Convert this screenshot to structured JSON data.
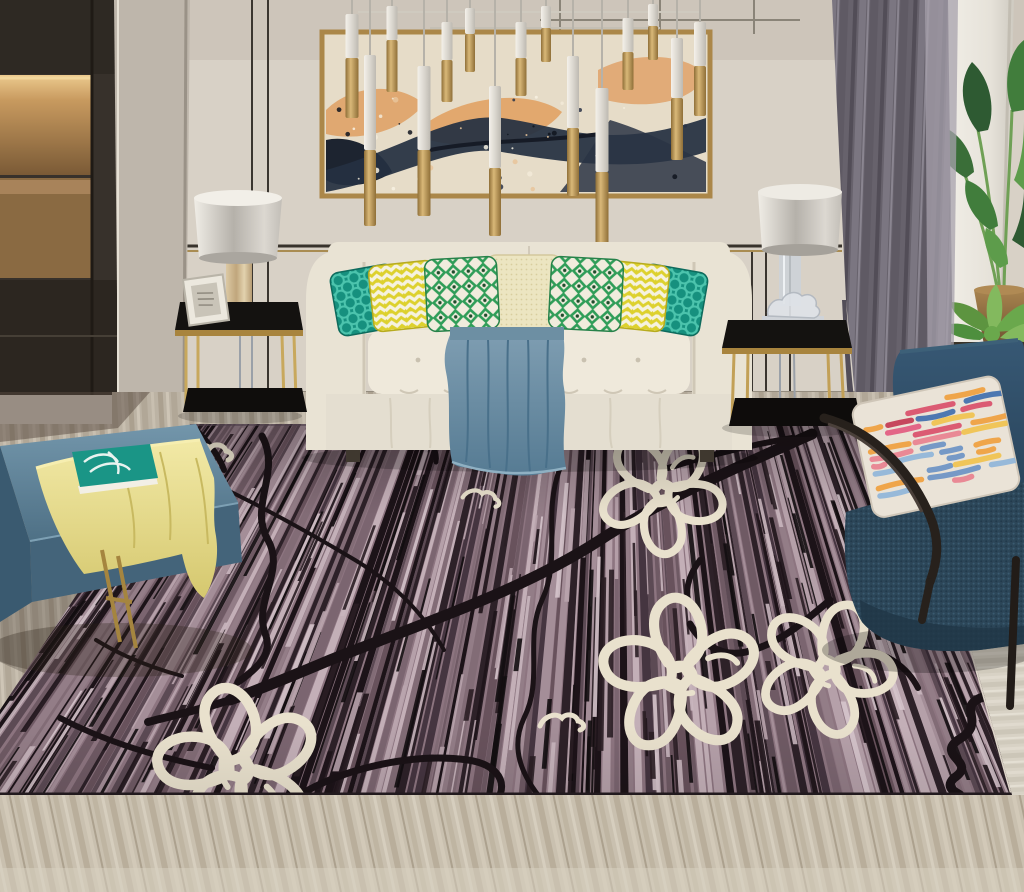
{
  "scene": {
    "type": "photograph",
    "subject": "modern living room with striped mauve area rug, floral outline pattern, cream tufted sofa, colorful pillows, abstract wall art, brass pendant lights, navy armchair and leather bench"
  },
  "palette": {
    "wall": "#d8d1c6",
    "panel_line": "#38332c",
    "gold_trim": "#a98c52",
    "cabinet": "#37312b",
    "cabinet_lower": "#2c2620",
    "niche_wood": "#b8884f",
    "niche_glow": "#ecca8e",
    "column": "#beb6ab",
    "canvas": "#e6dcc8",
    "paint_peach": "#dfa267",
    "paint_navy": "#253042",
    "paint_ink": "#161b26",
    "frame_gold": "#ab8749",
    "pendant_white": "#ece8e0",
    "pendant_gold": "#b28e4a",
    "curtain": "#67626c",
    "curtain_sheer": "#a7a2ac",
    "white_pillar": "#f0ede6",
    "leaf_dark": "#2e5a32",
    "leaf": "#417d3c",
    "leaf_light": "#5d9c4b",
    "bronze_pot": "#97744a",
    "succulent": "#5d9440",
    "gold_pot": "#c5a157",
    "lamp_shade": "#c9c5be",
    "marble": "#d3c3a0",
    "table_glass": "#141210",
    "table_gold": "#bd9a52",
    "sofa_body": "#e9e3d4",
    "sofa_cushion": "#efe9db",
    "sofa_skirt": "#e4ded0",
    "sofa_shadow": "#cfc7b6",
    "pillow_teal": "#16907e",
    "pillow_teal_light": "#4cc4ad",
    "pillow_chevron": "#ddd12e",
    "pillow_white": "#f6f2df",
    "pillow_green": "#2f9d58",
    "pillow_cream": "#ece5c1",
    "throw_light": "#7f9eb2",
    "throw_dark": "#567b93",
    "bench_top": "#5f8298",
    "bench_side": "#44647a",
    "bench_left": "#3a5a70",
    "bench_gold": "#a5853f",
    "cloth_yellow": "#eee49a",
    "book_cover": "#1a9586",
    "rug_base": "#8d7580",
    "rug_ink": "#1a1216",
    "rug_flower": "#e9e1cd",
    "rug_edge": "#ddd5c8",
    "chair_navy": "#2e4a5e",
    "chair_frame": "#27211c",
    "chair_pillow_base": "#eae3d7",
    "floor_strip": "#bcb3a4",
    "floor_right": "#d8d2c5",
    "floor_bottom": "#c9c0af"
  },
  "pendants": [
    {
      "x": 352,
      "w": 13,
      "a": 14,
      "b": 58,
      "c": 118
    },
    {
      "x": 370,
      "w": 12,
      "a": 55,
      "b": 150,
      "c": 226
    },
    {
      "x": 392,
      "w": 11,
      "a": 6,
      "b": 40,
      "c": 92
    },
    {
      "x": 424,
      "w": 13,
      "a": 66,
      "b": 150,
      "c": 216
    },
    {
      "x": 447,
      "w": 11,
      "a": 22,
      "b": 60,
      "c": 102
    },
    {
      "x": 470,
      "w": 10,
      "a": 8,
      "b": 34,
      "c": 72
    },
    {
      "x": 495,
      "w": 12,
      "a": 86,
      "b": 168,
      "c": 236
    },
    {
      "x": 521,
      "w": 11,
      "a": 22,
      "b": 58,
      "c": 96
    },
    {
      "x": 546,
      "w": 10,
      "a": 6,
      "b": 28,
      "c": 62
    },
    {
      "x": 573,
      "w": 12,
      "a": 56,
      "b": 128,
      "c": 196
    },
    {
      "x": 602,
      "w": 13,
      "a": 88,
      "b": 172,
      "c": 244
    },
    {
      "x": 628,
      "w": 11,
      "a": 18,
      "b": 52,
      "c": 90
    },
    {
      "x": 653,
      "w": 10,
      "a": 4,
      "b": 26,
      "c": 60
    },
    {
      "x": 677,
      "w": 12,
      "a": 38,
      "b": 98,
      "c": 160
    },
    {
      "x": 700,
      "w": 12,
      "a": 22,
      "b": 66,
      "c": 116
    }
  ],
  "rug": {
    "stripe_colors": [
      "#1c1318",
      "#2d2128",
      "#453540",
      "#5c4a54",
      "#6f5a64",
      "#826c76",
      "#937d87",
      "#a48e98",
      "#b5a0a9",
      "#c3afb7",
      "#7b6570",
      "#68525c"
    ],
    "segment_darks": [
      "#120d10",
      "#1e1419",
      "#2a1e24"
    ],
    "segment_lights": [
      "#c9b6be",
      "#d5c4cb",
      "#b9a4ad"
    ],
    "flowers": [
      {
        "x": 662,
        "y": 492,
        "s": 1.15,
        "r": -15
      },
      {
        "x": 680,
        "y": 676,
        "s": 1.45,
        "r": 20
      },
      {
        "x": 826,
        "y": 668,
        "s": 1.25,
        "r": 48
      },
      {
        "x": 238,
        "y": 768,
        "s": 1.5,
        "r": 85
      }
    ],
    "squiggles": [
      {
        "x": 208,
        "y": 452,
        "s": 1,
        "r": 0
      },
      {
        "x": 137,
        "y": 560,
        "s": 0.9,
        "r": -20
      },
      {
        "x": 480,
        "y": 497,
        "s": 0.85,
        "r": 10
      },
      {
        "x": 560,
        "y": 722,
        "s": 1,
        "r": 0
      },
      {
        "x": 930,
        "y": 612,
        "s": 1.1,
        "r": -30
      }
    ]
  },
  "chair_pillow_streaks": [
    "#d94f6a",
    "#ef9f3e",
    "#3f6fae",
    "#c23a52",
    "#8fb5d9",
    "#e8818f",
    "#f0c24e",
    "#e25b80",
    "#6b93c4"
  ]
}
